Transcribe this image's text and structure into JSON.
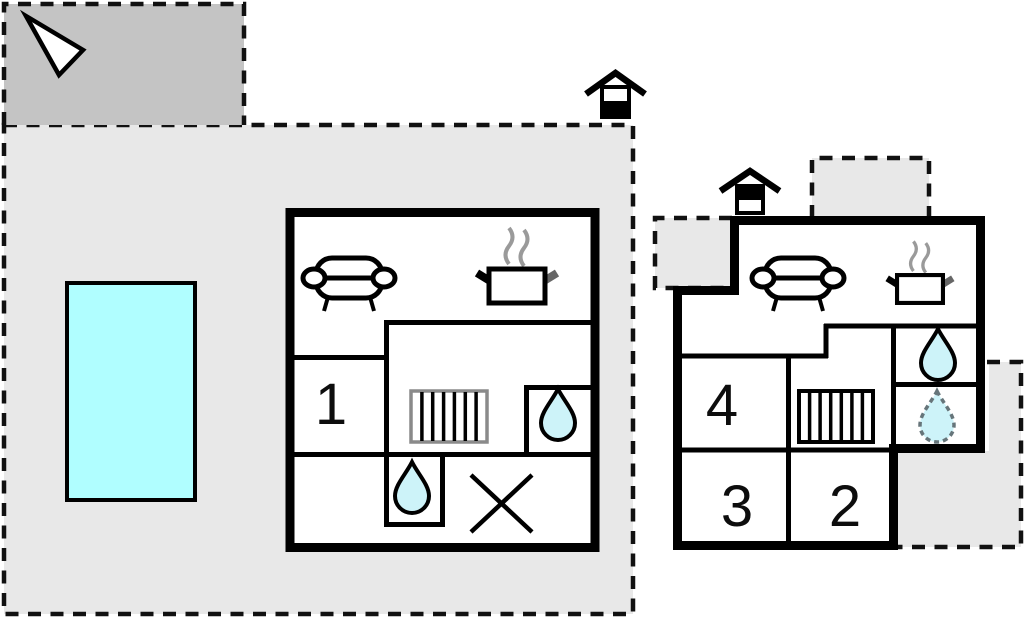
{
  "plan": {
    "type": "holiday-home-floor-plan",
    "floors": [
      {
        "id": "ground-floor",
        "indicator": "house-icon-black-bottom",
        "rooms": [
          {
            "number": "1"
          }
        ],
        "features": [
          "sofa",
          "stove",
          "staircase",
          "bathroom-drop",
          "bathroom-drop",
          "cross-void"
        ]
      },
      {
        "id": "upper-floor",
        "indicator": "house-icon-black-top",
        "rooms": [
          {
            "number": "4"
          },
          {
            "number": "3"
          },
          {
            "number": "2"
          }
        ],
        "features": [
          "sofa",
          "stove",
          "staircase",
          "bathroom-drop",
          "bathroom-drop-dashed"
        ]
      }
    ]
  },
  "rooms": {
    "r1": "1",
    "r2": "2",
    "r3": "3",
    "r4": "4"
  },
  "icons": {
    "north_arrow": "triangle-pointer",
    "pool": "swimming-pool",
    "sofa": "couch",
    "stove": "pot-with-steam",
    "stairs": "staircase-bars",
    "drop": "water-drop",
    "cross": "x-void",
    "ground_floor_house": "house-lower-half-black",
    "upper_floor_house": "house-upper-half-black"
  },
  "colors": {
    "wall": "#000000",
    "floor": "#ffffff",
    "terrain": "#e8e8e8",
    "terrain_dark": "#c4c4c4",
    "pool": "#b0feff",
    "drop": "#cdf3f9",
    "steam": "#9a9a9a",
    "stairs_gray": "#8a8a8a",
    "dash": "#111111"
  }
}
